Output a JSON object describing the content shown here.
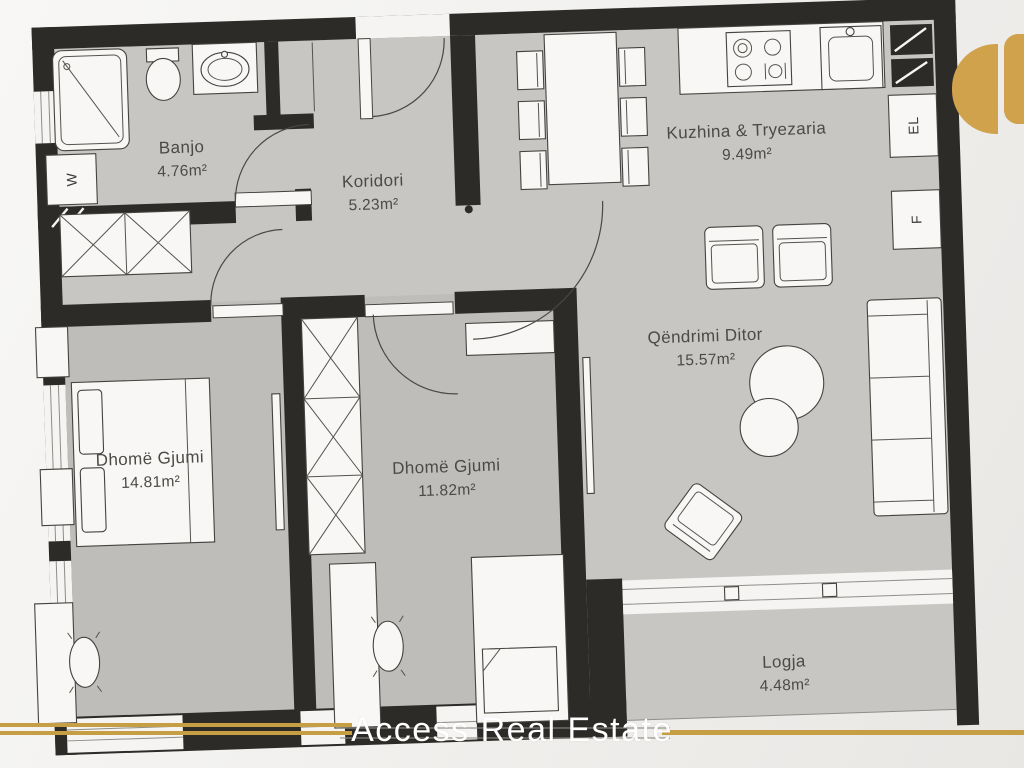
{
  "rooms": [
    {
      "id": "banjo",
      "name": "Banjo",
      "area": "4.76m²"
    },
    {
      "id": "koridori",
      "name": "Koridori",
      "area": "5.23m²"
    },
    {
      "id": "kuzhina",
      "name": "Kuzhina & Tryezaria",
      "area": "9.49m²"
    },
    {
      "id": "qendrimi",
      "name": "Qëndrimi Ditor",
      "area": "15.57m²"
    },
    {
      "id": "dhome-gjumi-1",
      "name": "Dhomë Gjumi",
      "area": "14.81m²"
    },
    {
      "id": "dhome-gjumi-2",
      "name": "Dhomë Gjumi",
      "area": "11.82m²"
    },
    {
      "id": "logja",
      "name": "Logja",
      "area": "4.48m²"
    }
  ],
  "appliance_labels": {
    "washer": "W",
    "electric": "EL",
    "fridge": "F"
  },
  "watermark": {
    "text": "Access Real Estate"
  },
  "colors": {
    "wall": "#2d2b28",
    "floor": "#c8c6c3",
    "background": "#f2f1ef",
    "gold_line": "#c69f45",
    "logo_gold": "#cfa24b",
    "label_text": "#4c4a46",
    "watermark_text": "#ffffff"
  }
}
